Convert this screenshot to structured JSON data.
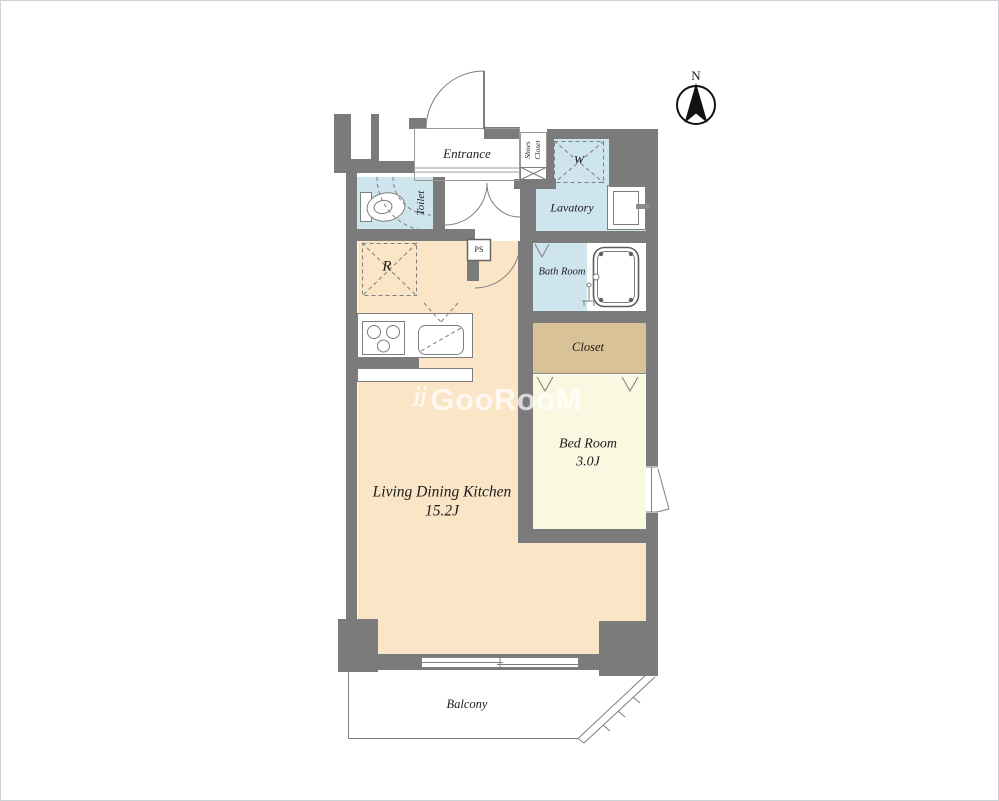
{
  "rooms": {
    "ldk": {
      "label": "Living Dining Kitchen",
      "size": "15.2J"
    },
    "bedroom": {
      "label": "Bed Room",
      "size": "3.0J"
    },
    "closet": {
      "label": "Closet"
    },
    "bath": {
      "label": "Bath Room"
    },
    "lavatory": {
      "label": "Lavatory"
    },
    "toilet": {
      "label": "Toilet"
    },
    "entrance": {
      "label": "Entrance"
    },
    "shoes_closet": {
      "line1": "Shoes",
      "line2": "Closet"
    },
    "washer": {
      "label": "W"
    },
    "refrigerator": {
      "label": "R"
    },
    "pipe_space": {
      "label": "PS"
    },
    "balcony": {
      "label": "Balcony"
    }
  },
  "compass": {
    "north": "N"
  },
  "watermark": {
    "logo": "jj",
    "text": "GooRooM"
  },
  "colors": {
    "wall": "#7b7b7b",
    "ldk_floor": "#fae5c6",
    "bedroom_floor": "#fbf8e2",
    "wet_floor": "#cfe5ee",
    "closet_floor": "#d9c297",
    "label": "#1c1c1c",
    "watermark": "rgba(255,255,255,0.72)"
  }
}
